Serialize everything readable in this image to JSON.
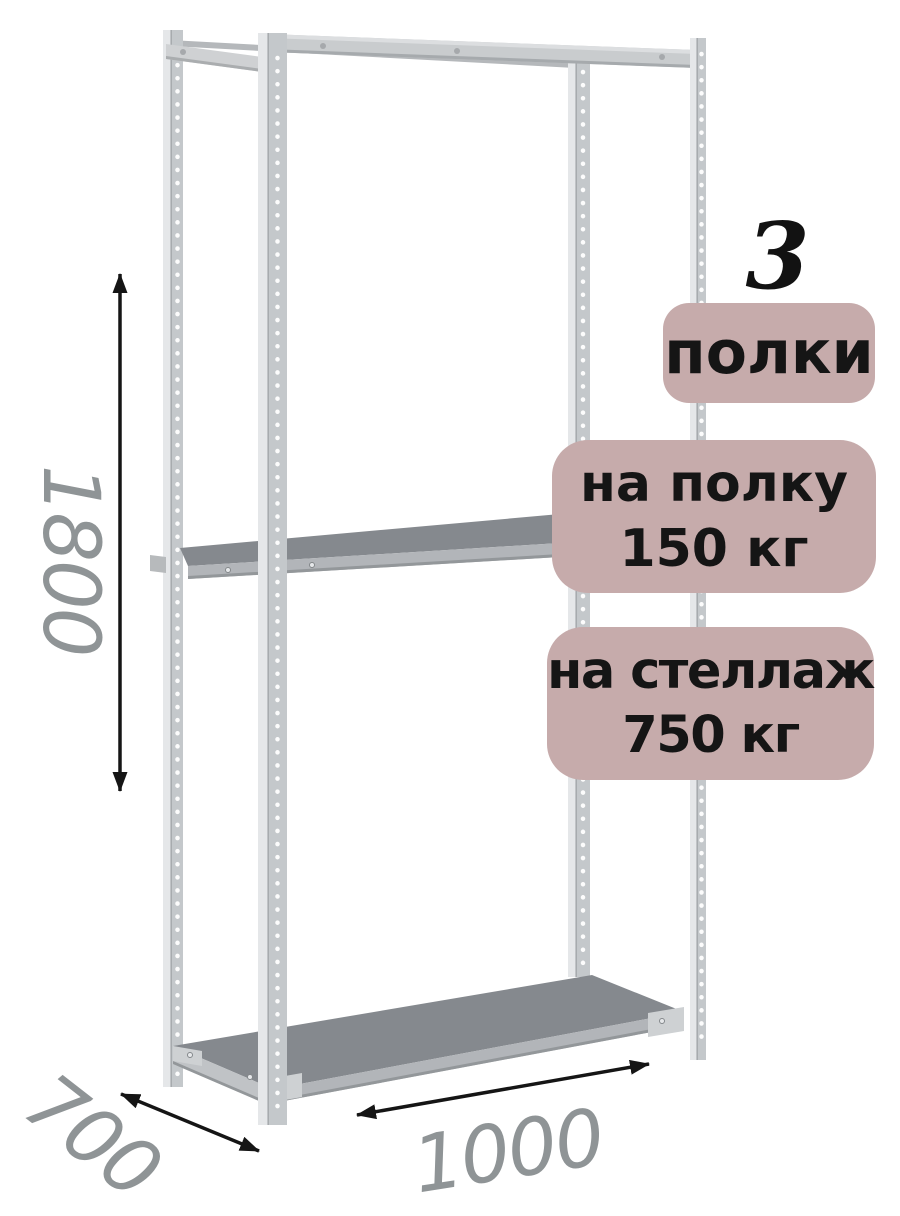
{
  "annotations": {
    "shelf_count": "3",
    "shelf_count_label": "полки",
    "shelf_load": {
      "line1": "на полку",
      "line2": "150 кг"
    },
    "rack_load": {
      "line1": "на стеллаж",
      "line2": "750 кг"
    }
  },
  "dimensions": {
    "height": "1800",
    "depth": "700",
    "width": "1000"
  },
  "colors": {
    "badge_bg": "#c6abab",
    "badge_text": "#151515",
    "dim_text": "#8f9496",
    "arrow": "#151515",
    "metal_light": "#e5e7e9",
    "metal_mid": "#c4c8cb",
    "metal_edge": "#9b9fa2",
    "shelf_top": "#85898e",
    "shelf_front": "#b2b5b9",
    "shelf_side": "#c0c3c6",
    "plate": "#ced1d3"
  }
}
